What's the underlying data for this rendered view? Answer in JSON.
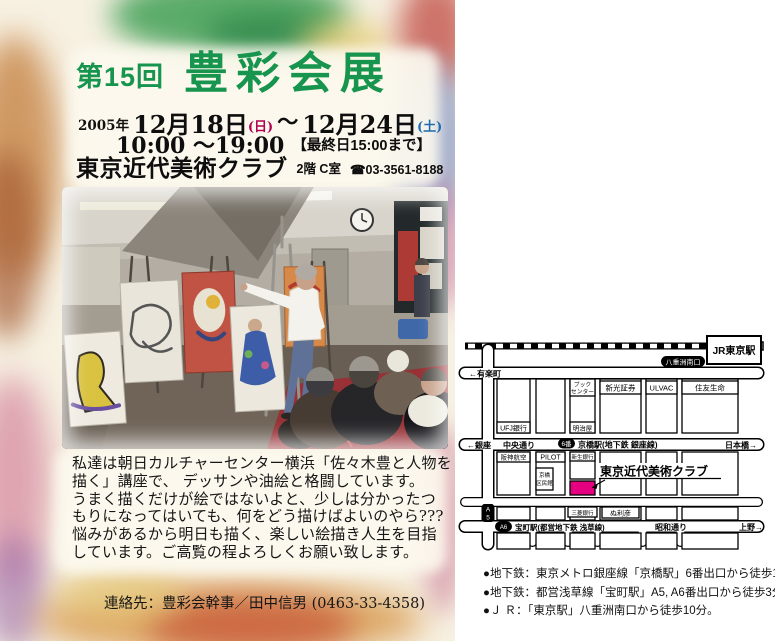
{
  "flyer": {
    "edition": "第15回",
    "title": "豊彩会展",
    "year": "2005年",
    "start_date": "12月18日",
    "start_day": "(日)",
    "range_tilde": "～",
    "end_date": "12月24日",
    "end_day": "(土)",
    "hours": "10:00 ～19:00",
    "hours_note": "【最終日15:00まで】",
    "venue": "東京近代美術クラブ",
    "venue_floor": "2階 C室",
    "venue_phone": "☎03-3561-8188",
    "description_lines": [
      "私達は朝日カルチャーセンター横浜「佐々木豊と人物を",
      "描く」講座で、 デッサンや油絵と格闘しています。",
      "うまく描くだけが絵ではないよと、少しは分かったつ",
      "もりになってはいても、何をどう描けばよいのやら???",
      "悩みがあるから明日も描く、楽しい絵描き人生を目指",
      "しています。ご高覧の程よろしくお願い致します。"
    ],
    "contact": "連絡先：豊彩会幹事／田中信男 (0463-33-4358)",
    "colors": {
      "title_green": "#17944d",
      "sunday_red": "#b00050",
      "saturday_blue": "#1e6cb0",
      "highlight_magenta": "#e5007f"
    }
  },
  "map": {
    "jr_station": "JR東京駅",
    "yaesu_exit": "八重洲南口",
    "street_yurakucho": "←有楽町",
    "street_ginza": "←銀座",
    "street_chuo_dori": "中央通り",
    "exit6_badge": "6番",
    "kyobashi_station": "京橋駅(地下鉄 銀座線)",
    "street_nihonbashi": "日本橋→",
    "bldg_ufj": "UFJ銀行",
    "bldg_book_1": "ブック",
    "bldg_book_2": "センター",
    "bldg_meijiya": "明治屋",
    "bldg_shinko": "新光証券",
    "bldg_ulvac": "ULVAC",
    "bldg_sumitomo": "住友生命",
    "bldg_hanshin": "阪神航空",
    "bldg_pilot": "PILOT",
    "bldg_kumin_1": "京橋",
    "bldg_kumin_2": "区民館",
    "bldg_bank_a": "新生銀行",
    "club_label": "東京近代美術クラブ",
    "bldg_bank_b": "三菱銀行",
    "bldg_nurihiko": "ぬ利彦",
    "a5_line1": "A",
    "a5_line2": "5",
    "a6_badge": "A6",
    "takaracho_station": "宝町駅(都営地下鉄 浅草線)",
    "street_showa_dori": "昭和通り",
    "street_ueno": "上野→"
  },
  "access": {
    "lines": [
      "●地下鉄：東京メトロ銀座線「京橋駅」6番出口から徒歩1分。",
      "●地下鉄：都営浅草線「宝町駅」A5, A6番出口から徒歩3分。",
      "●Ｊ Ｒ：「東京駅」八重洲南口から徒歩10分。"
    ]
  }
}
